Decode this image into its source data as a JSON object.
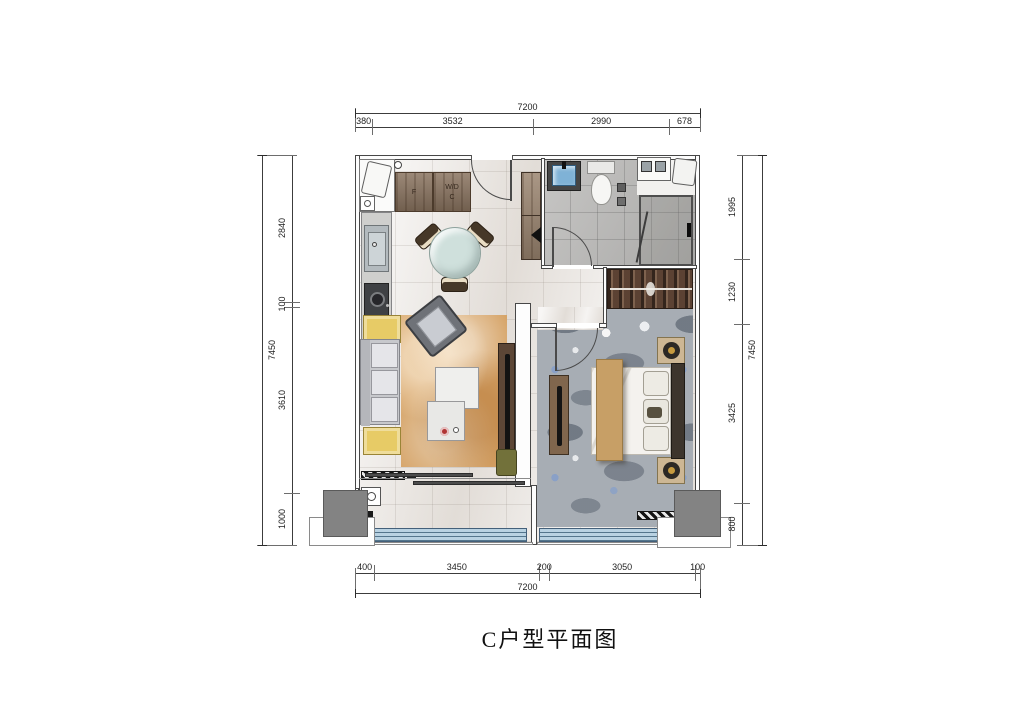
{
  "title": "C户型平面图",
  "dimensions": {
    "top": {
      "total": "7200",
      "segments": [
        "380",
        "3532",
        "2990",
        "678"
      ]
    },
    "bottom": {
      "total": "7200",
      "segments": [
        "400",
        "3450",
        "200",
        "3050",
        "100"
      ]
    },
    "left": {
      "total": "7450",
      "segments": [
        "2840",
        "100",
        "3610",
        "1000"
      ]
    },
    "right": {
      "total": "7450",
      "segments": [
        "1995",
        "1230",
        "3425",
        "800"
      ]
    }
  },
  "labels": {
    "cabinet_f": "F",
    "cabinet_wd": "W/D",
    "cabinet_c": "C"
  },
  "colors": {
    "marble": "#eae6e2",
    "tile": "#b4b3b1",
    "carpet": "#a7adb4",
    "rug": "#d6a468",
    "wood": "#8a7460",
    "wardrobe": "#5c4638",
    "window_glass": "#b9d2e2",
    "accent_yellow": "#e7cb66",
    "ac_block": "#838383",
    "basin_blue": "#7fb2d6"
  }
}
